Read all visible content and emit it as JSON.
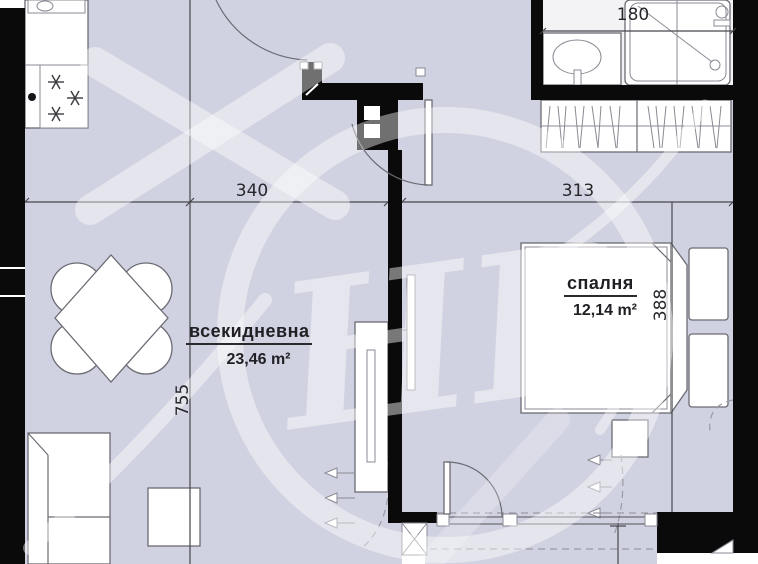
{
  "plan": {
    "rooms": {
      "living": {
        "name": "всекидневна",
        "area": "23,46 m²"
      },
      "bedroom": {
        "name": "спалня",
        "area": "12,14 m²"
      }
    },
    "dimensions": {
      "living_width": "340",
      "bedroom_width": "313",
      "bath_width": "180",
      "living_height": "755",
      "bedroom_height": "388"
    },
    "colors": {
      "floor": "#d1d2e1",
      "bath_floor": "#f3f3f6",
      "wall": "#0a0a0a",
      "furniture_outline": "#6b6b74",
      "dimension_text": "#26262b",
      "watermark": "rgba(255,255,255,0.45)"
    },
    "watermark_letters": "НВ"
  }
}
